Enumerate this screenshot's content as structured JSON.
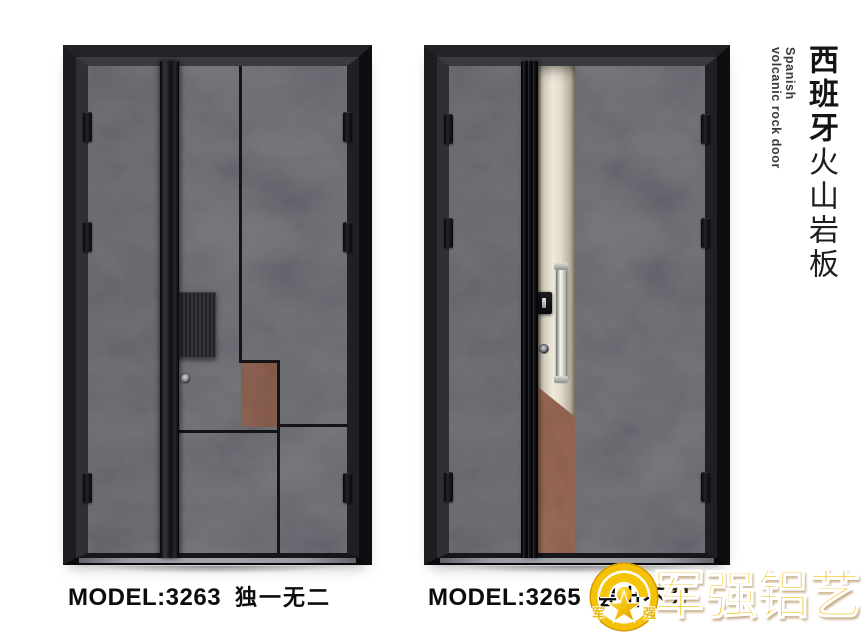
{
  "poster": {
    "products": [
      {
        "model": "MODEL:3263",
        "tagline": "独一无二"
      },
      {
        "model": "MODEL:3265",
        "tagline": "层出不穷"
      }
    ],
    "side_title": {
      "cn_bold": "西班牙",
      "cn_regular": "火山岩板",
      "en_line1": "Spanish",
      "en_line2": "volcanic rock door"
    },
    "brand": {
      "wordmark": "军强铝艺",
      "emblem_char_left": "军",
      "emblem_char_right": "强"
    },
    "colors": {
      "rock_grey": "#57575d",
      "rust_accent": "#7c4630",
      "rust_strip": "#8a5138",
      "champagne": "#e9e3d5",
      "frame_black": "#141417",
      "brand_gold": "#f3bd05"
    }
  }
}
